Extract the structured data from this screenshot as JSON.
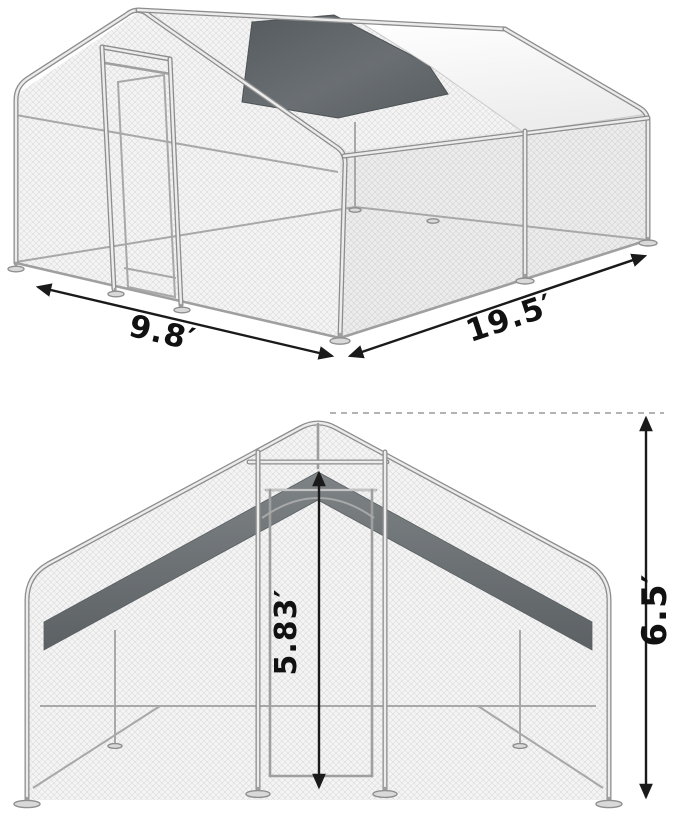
{
  "diagram": {
    "subject": "metal walk-in chicken run cage with peaked mesh roof and partial covers",
    "dims": {
      "width": "9.8′",
      "length": "19.5′",
      "door_height": "5.83′",
      "total_height": "6.5′"
    },
    "colors": {
      "frame": "#8d8d8d",
      "mesh_fill": "#f4f4f4",
      "mesh_line": "#dcdcdc",
      "dark_cover": "#63686c",
      "light_cover": "#fafafa",
      "dimension_ink": "#1a1a1a"
    }
  }
}
